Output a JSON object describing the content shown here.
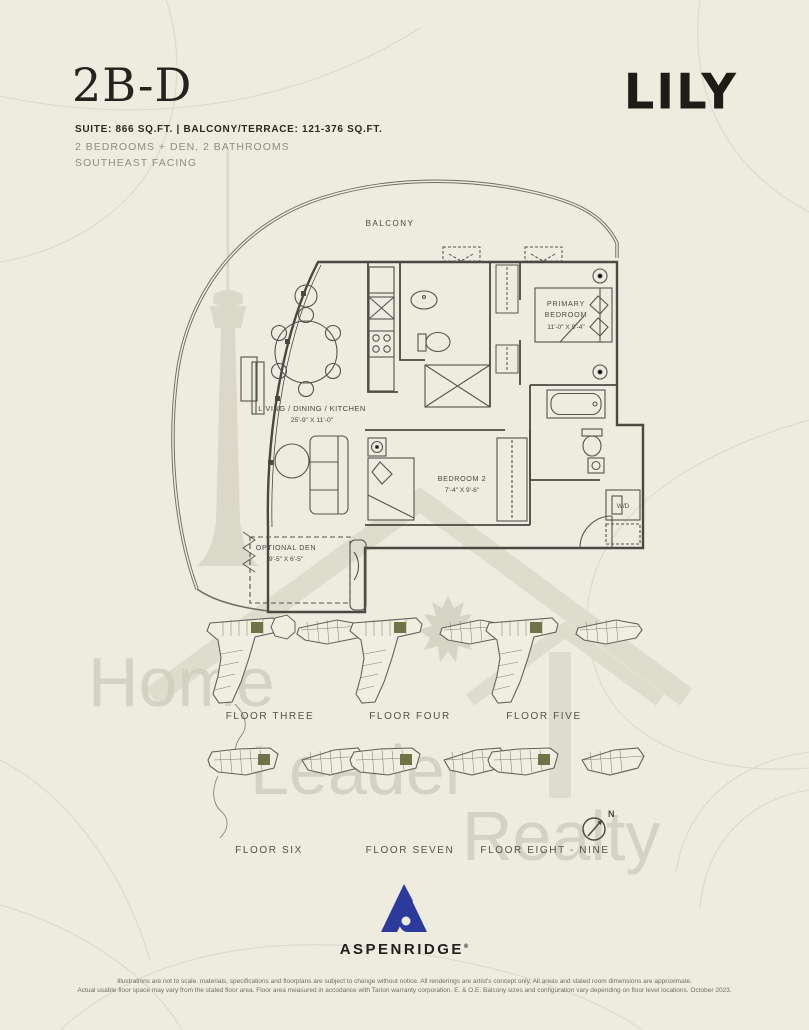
{
  "header": {
    "unit_code": "2B-D",
    "brand": "LILY",
    "suite_line": "SUITE: 866 SQ.FT.  |  BALCONY/TERRACE: 121-376 SQ.FT.",
    "rooms_line": "2 BEDROOMS + DEN, 2 BATHROOMS",
    "facing_line": "SOUTHEAST FACING"
  },
  "floorplan": {
    "balcony_label": "BALCONY",
    "living": {
      "name": "LIVING / DINING / KITCHEN",
      "dims": "25'-9\" X 11'-0\""
    },
    "primary": {
      "line1": "PRIMARY",
      "line2": "BEDROOM",
      "dims": "11'-0\" X 9'-4\""
    },
    "bedroom2": {
      "name": "BEDROOM 2",
      "dims": "7'-4\" X 9'-6\""
    },
    "den": {
      "name": "OPTIONAL DEN",
      "dims": "9'-5\" X 6'-5\""
    },
    "laundry_label": "W/D"
  },
  "keyplans": {
    "items": [
      {
        "label": "FLOOR THREE"
      },
      {
        "label": "FLOOR FOUR"
      },
      {
        "label": "FLOOR FIVE"
      },
      {
        "label": "FLOOR SIX"
      },
      {
        "label": "FLOOR SEVEN"
      },
      {
        "label": "FLOOR EIGHT - NINE"
      }
    ]
  },
  "compass": {
    "label": "N"
  },
  "watermark": {
    "words": [
      "Home",
      "Leader",
      "Realty"
    ]
  },
  "footer": {
    "developer": "ASPENRIDGE",
    "trademark": "®",
    "disclaimer_line1": "Illustrations are not to scale. materials, specifications and floorplans are subject to change without notice. All renderings are artist's concept only. All areas and stated room dimensions are approximate.",
    "disclaimer_line2": "Actual usable floor space may vary from the stated floor area. Floor area measured in accodance with Tarion warranty corporation. E. & O.E. Balcony sizes and configuration vary depending on floor level locations. October 2023."
  },
  "colors": {
    "background": "#edecdf",
    "plan_line": "#4a4941",
    "watermark_gray": "#d7d5c5",
    "unit_highlight_green": "#6f7348",
    "developer_blue": "#2c3a9c"
  }
}
